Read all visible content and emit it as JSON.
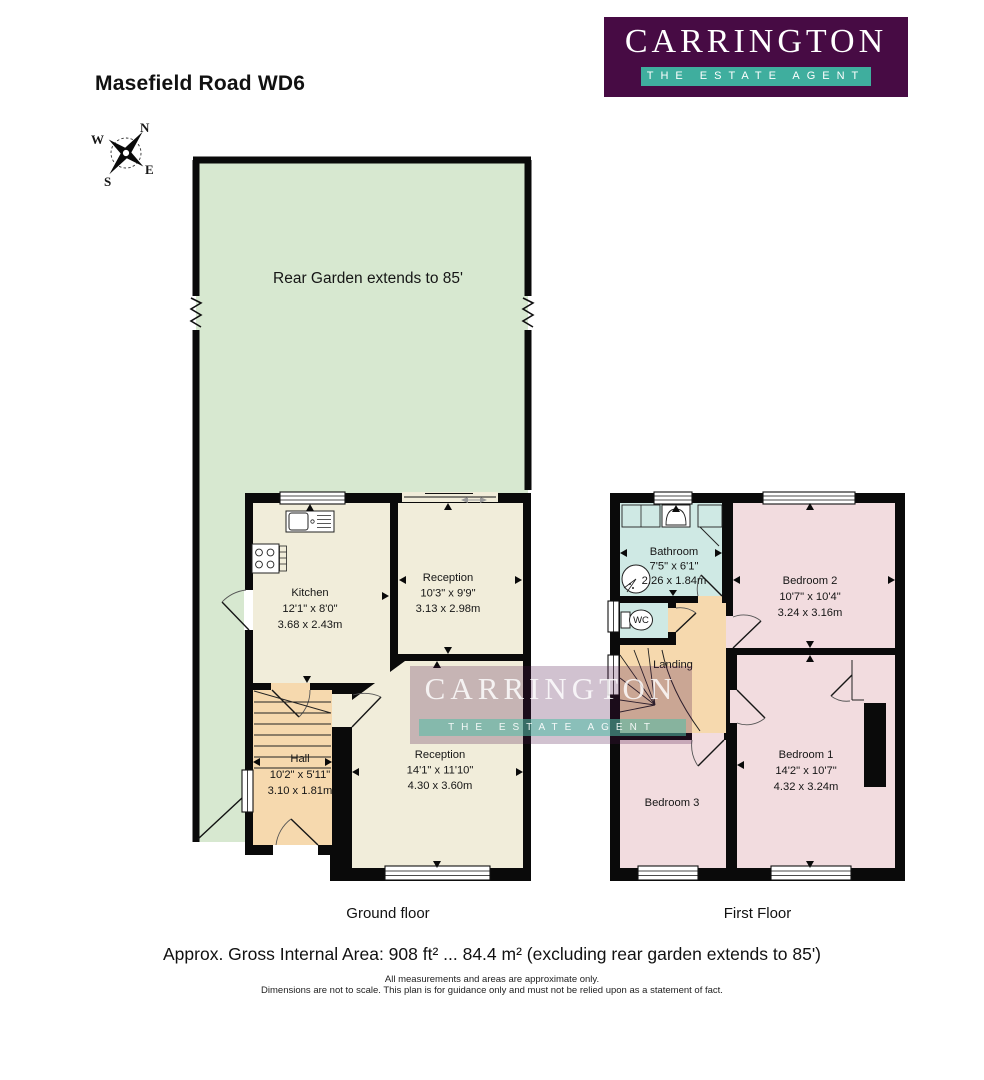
{
  "header": {
    "title": "Masefield Road WD6"
  },
  "logo": {
    "name": "CARRINGTON",
    "tagline": "THE ESTATE AGENT"
  },
  "watermark": {
    "name": "CARRINGTON",
    "tagline": "THE ESTATE AGENT"
  },
  "compass": {
    "north": "N",
    "east": "E",
    "south": "S",
    "west": "W"
  },
  "garden": {
    "label": "Rear Garden extends to 85'"
  },
  "ground_floor": {
    "label": "Ground floor",
    "rooms": {
      "kitchen": {
        "name": "Kitchen",
        "size_imperial": "12'1\" x 8'0\"",
        "size_metric": "3.68 x 2.43m"
      },
      "reception_rear": {
        "name": "Reception",
        "size_imperial": "10'3\" x 9'9\"",
        "size_metric": "3.13 x 2.98m"
      },
      "reception_front": {
        "name": "Reception",
        "size_imperial": "14'1\" x 11'10\"",
        "size_metric": "4.30 x 3.60m"
      },
      "hall": {
        "name": "Hall",
        "size_imperial": "10'2\" x 5'11\"",
        "size_metric": "3.10 x 1.81m"
      }
    }
  },
  "first_floor": {
    "label": "First Floor",
    "rooms": {
      "bathroom": {
        "name": "Bathroom",
        "size_imperial": "7'5\" x 6'1\"",
        "size_metric": "2.26 x 1.84m"
      },
      "wc": {
        "name": "WC"
      },
      "landing": {
        "name": "Landing"
      },
      "bedroom2": {
        "name": "Bedroom 2",
        "size_imperial": "10'7\" x 10'4\"",
        "size_metric": "3.24 x 3.16m"
      },
      "bedroom1": {
        "name": "Bedroom 1",
        "size_imperial": "14'2\" x 10'7\"",
        "size_metric": "4.32 x 3.24m"
      },
      "bedroom3": {
        "name": "Bedroom 3"
      }
    }
  },
  "footer": {
    "area_summary": "Approx. Gross Internal Area: 908 ft² ... 84.4 m² (excluding rear garden extends to 85')",
    "disclaimer_line1": "All measurements and areas are approximate only.",
    "disclaimer_line2": "Dimensions are not to scale. This plan is for guidance only and must not be relied upon as a statement of fact."
  },
  "colors": {
    "logo_purple": "#470b44",
    "logo_teal": "#3fae9e",
    "garden_green": "#d7e8d0",
    "floor_cream": "#f1edda",
    "hall_tan": "#f6d9ae",
    "bathroom_blue": "#cfe9e4",
    "bedroom_pink": "#f2dcdf",
    "wall_black": "#0a0a0a"
  }
}
